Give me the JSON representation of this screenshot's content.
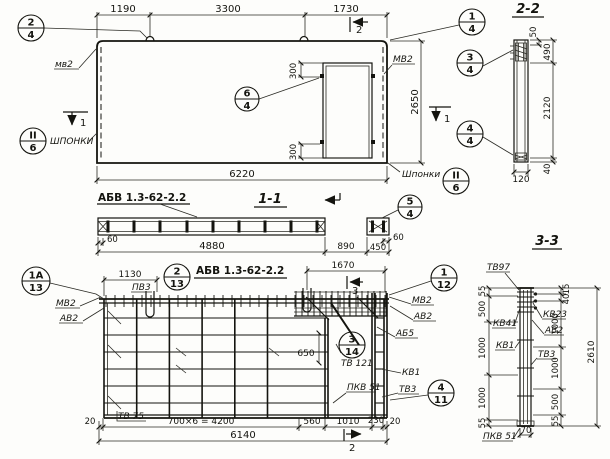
{
  "plan": {
    "dim_1190": "1190",
    "dim_3300": "3300",
    "dim_1730": "1730",
    "dim_6220": "6220",
    "dim_2650": "2650",
    "dim_300_top": "300",
    "dim_300_bottom": "300",
    "label_mv2_left": "мв2",
    "label_mv2_right": "МВ2",
    "label_keys_left": "ШПОНКИ",
    "label_keys_right": "Шпонки",
    "callout_2_4": {
      "num": "2",
      "den": "4"
    },
    "callout_1_4": {
      "num": "1",
      "den": "4"
    },
    "callout_6_4": {
      "num": "6",
      "den": "4"
    },
    "callout_keys_left": {
      "num": "II",
      "den": "6"
    },
    "callout_keys_right": {
      "num": "II",
      "den": "6"
    },
    "mark_2": "2",
    "mark_1_left": "1",
    "mark_1_right": "1"
  },
  "section22": {
    "title": "2-2",
    "callout_3_4": {
      "num": "3",
      "den": "4"
    },
    "callout_4_4": {
      "num": "4",
      "den": "4"
    },
    "dim_50": "50",
    "dim_490": "490",
    "dim_2120": "2120",
    "dim_40": "40",
    "dim_120": "120"
  },
  "section11": {
    "title": "1-1",
    "panel_mark": "АБВ 1.3-62-2.2",
    "callout_5_4": {
      "num": "5",
      "den": "4"
    },
    "dim_60_left": "60",
    "dim_4880": "4880",
    "dim_890": "890",
    "dim_450": "450",
    "dim_60_right": "60"
  },
  "reinf": {
    "title": "АБВ 1.3-62-2.2",
    "callout_1a_13": {
      "num": "1А",
      "den": "13"
    },
    "callout_2_13": {
      "num": "2",
      "den": "13"
    },
    "callout_1_12": {
      "num": "1",
      "den": "12"
    },
    "callout_3_14": {
      "num": "3",
      "den": "14"
    },
    "callout_4_11": {
      "num": "4",
      "den": "11"
    },
    "dim_1130": "1130",
    "dim_1670": "1670",
    "dim_650": "650",
    "dim_20_left": "20",
    "dim_4200": "700×6 = 4200",
    "dim_560": "560",
    "dim_1010": "1010",
    "dim_230": "230",
    "dim_20_right": "20",
    "dim_6140": "6140",
    "label_pv3": "ПВ3",
    "label_mv2_left": "МВ2",
    "label_av2_left": "АВ2",
    "label_mv2_right": "МВ2",
    "label_av2_right": "АВ2",
    "label_ab5": "АБ5",
    "label_kv1": "КВ1",
    "label_tv3": "ТВ3",
    "label_tv121": "ТВ 121",
    "label_pkv51": "ПКВ 51",
    "label_tv75": "ТВ 75",
    "mark_3": "3",
    "mark_2": "2"
  },
  "section33": {
    "title": "3-3",
    "label_tv97": "ТВ97",
    "label_kv41": "КВ41",
    "label_kv23": "КВ23",
    "label_av2": "АВ2",
    "label_kv1": "КВ1",
    "label_tv3": "ТВ3",
    "label_pkv51": "ПКВ 51",
    "dims_left": [
      "55",
      "500",
      "1000",
      "1000",
      "55"
    ],
    "dims_right": [
      "15",
      "40",
      "1000",
      "1000",
      "500",
      "55"
    ],
    "dim_2610": "2610",
    "dim_70": "70"
  }
}
